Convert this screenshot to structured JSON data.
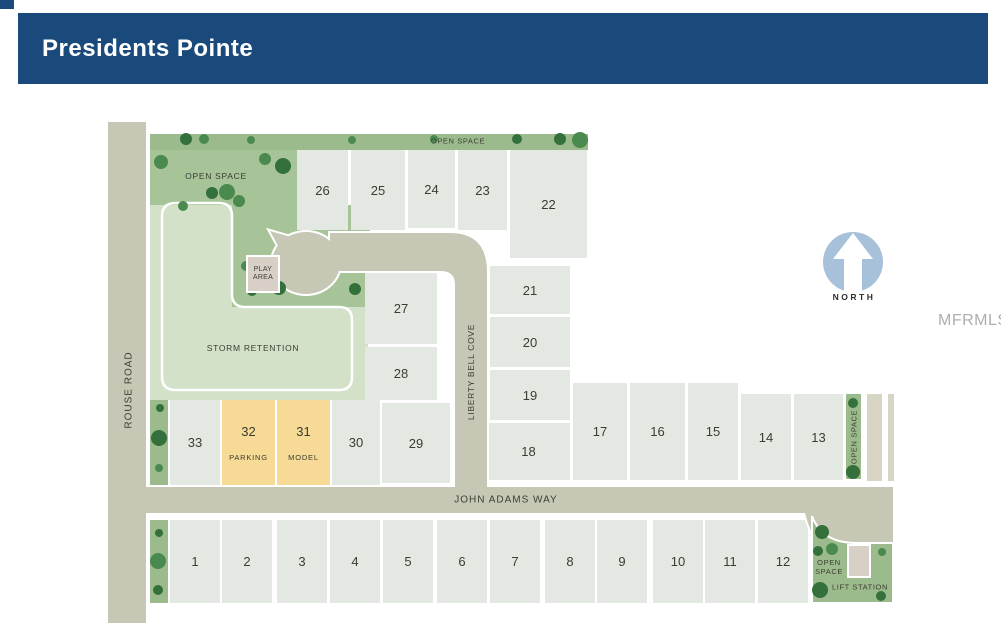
{
  "header": {
    "title": "Presidents Pointe"
  },
  "watermark": "MFRMLS",
  "compass": {
    "label": "NORTH"
  },
  "streets": {
    "rouse_road": "ROUSE ROAD",
    "john_adams_way": "JOHN ADAMS WAY",
    "liberty_bell_cove": "LIBERTY BELL COVE"
  },
  "labels": {
    "open_space_top": "OPEN SPACE",
    "open_space_left": "OPEN SPACE",
    "open_space_right": "OPEN SPACE",
    "open_space_bottom_right": "OPEN SPACE",
    "storm_retention": "STORM RETENTION",
    "play_area": "PLAY AREA",
    "lift_station": "LIFT STATION"
  },
  "colors": {
    "header_blue": "#1a4a7c",
    "road": "#c6c8b5",
    "strip_tan": "#d9d5c5",
    "green_dark": "#9cbb8c",
    "green_open": "#a6c497",
    "green_light": "#d3e1c8",
    "lot_fill": "#e3e9e2",
    "lot_yellow": "#f6da95",
    "pad_tan": "#d8cfc6",
    "compass_blue": "#a7c1da",
    "white": "#ffffff"
  },
  "lots": [
    {
      "n": "1",
      "x": 170,
      "y": 520,
      "w": 50,
      "h": 83,
      "kind": "standard"
    },
    {
      "n": "2",
      "x": 222,
      "y": 520,
      "w": 50,
      "h": 83,
      "kind": "standard"
    },
    {
      "n": "3",
      "x": 277,
      "y": 520,
      "w": 50,
      "h": 83,
      "kind": "standard"
    },
    {
      "n": "4",
      "x": 330,
      "y": 520,
      "w": 50,
      "h": 83,
      "kind": "standard"
    },
    {
      "n": "5",
      "x": 383,
      "y": 520,
      "w": 50,
      "h": 83,
      "kind": "standard"
    },
    {
      "n": "6",
      "x": 437,
      "y": 520,
      "w": 50,
      "h": 83,
      "kind": "standard"
    },
    {
      "n": "7",
      "x": 490,
      "y": 520,
      "w": 50,
      "h": 83,
      "kind": "standard"
    },
    {
      "n": "8",
      "x": 545,
      "y": 520,
      "w": 50,
      "h": 83,
      "kind": "standard"
    },
    {
      "n": "9",
      "x": 597,
      "y": 520,
      "w": 50,
      "h": 83,
      "kind": "standard"
    },
    {
      "n": "10",
      "x": 653,
      "y": 520,
      "w": 50,
      "h": 83,
      "kind": "standard"
    },
    {
      "n": "11",
      "x": 705,
      "y": 520,
      "w": 50,
      "h": 83,
      "kind": "standard"
    },
    {
      "n": "12",
      "x": 758,
      "y": 520,
      "w": 50,
      "h": 83,
      "kind": "standard"
    },
    {
      "n": "13",
      "x": 794,
      "y": 394,
      "w": 49,
      "h": 86,
      "kind": "standard"
    },
    {
      "n": "14",
      "x": 741,
      "y": 394,
      "w": 50,
      "h": 86,
      "kind": "standard"
    },
    {
      "n": "15",
      "x": 688,
      "y": 383,
      "w": 50,
      "h": 97,
      "kind": "standard"
    },
    {
      "n": "16",
      "x": 630,
      "y": 383,
      "w": 55,
      "h": 97,
      "kind": "standard"
    },
    {
      "n": "17",
      "x": 573,
      "y": 383,
      "w": 54,
      "h": 97,
      "kind": "standard"
    },
    {
      "n": "18",
      "x": 487,
      "y": 423,
      "w": 83,
      "h": 57,
      "kind": "standard"
    },
    {
      "n": "19",
      "x": 490,
      "y": 370,
      "w": 80,
      "h": 50,
      "kind": "standard"
    },
    {
      "n": "20",
      "x": 490,
      "y": 317,
      "w": 80,
      "h": 50,
      "kind": "standard"
    },
    {
      "n": "21",
      "x": 490,
      "y": 266,
      "w": 80,
      "h": 48,
      "kind": "standard"
    },
    {
      "n": "22",
      "x": 510,
      "y": 150,
      "w": 77,
      "h": 108,
      "kind": "standard"
    },
    {
      "n": "23",
      "x": 458,
      "y": 150,
      "w": 49,
      "h": 80,
      "kind": "standard"
    },
    {
      "n": "24",
      "x": 408,
      "y": 150,
      "w": 47,
      "h": 78,
      "kind": "standard"
    },
    {
      "n": "25",
      "x": 351,
      "y": 150,
      "w": 54,
      "h": 80,
      "kind": "standard"
    },
    {
      "n": "26",
      "x": 297,
      "y": 150,
      "w": 51,
      "h": 80,
      "kind": "standard"
    },
    {
      "n": "27",
      "x": 365,
      "y": 272,
      "w": 72,
      "h": 72,
      "kind": "standard"
    },
    {
      "n": "28",
      "x": 365,
      "y": 347,
      "w": 72,
      "h": 53,
      "kind": "standard"
    },
    {
      "n": "29",
      "x": 382,
      "y": 403,
      "w": 68,
      "h": 80,
      "kind": "standard"
    },
    {
      "n": "30",
      "x": 332,
      "y": 400,
      "w": 48,
      "h": 85,
      "kind": "standard"
    },
    {
      "n": "31",
      "x": 277,
      "y": 400,
      "w": 53,
      "h": 85,
      "kind": "model",
      "tag": "MODEL"
    },
    {
      "n": "32",
      "x": 222,
      "y": 400,
      "w": 53,
      "h": 85,
      "kind": "parking",
      "tag": "PARKING"
    },
    {
      "n": "33",
      "x": 170,
      "y": 400,
      "w": 50,
      "h": 85,
      "kind": "standard"
    }
  ],
  "trees": [
    [
      186,
      139,
      6,
      "d"
    ],
    [
      204,
      139,
      5,
      "m"
    ],
    [
      251,
      140,
      4,
      "m"
    ],
    [
      352,
      140,
      4,
      "m"
    ],
    [
      434,
      139,
      4,
      "m"
    ],
    [
      517,
      139,
      5,
      "d"
    ],
    [
      560,
      139,
      6,
      "d"
    ],
    [
      580,
      140,
      8,
      "m"
    ],
    [
      161,
      162,
      7,
      "m"
    ],
    [
      183,
      206,
      5,
      "m"
    ],
    [
      265,
      159,
      6,
      "m"
    ],
    [
      283,
      166,
      8,
      "d"
    ],
    [
      212,
      193,
      6,
      "d"
    ],
    [
      227,
      192,
      8,
      "m"
    ],
    [
      239,
      201,
      6,
      "m"
    ],
    [
      246,
      266,
      5,
      "m"
    ],
    [
      279,
      288,
      7,
      "d"
    ],
    [
      252,
      291,
      5,
      "d"
    ],
    [
      355,
      289,
      6,
      "d"
    ],
    [
      160,
      408,
      4,
      "d"
    ],
    [
      159,
      438,
      8,
      "d"
    ],
    [
      159,
      468,
      4,
      "m"
    ],
    [
      159,
      533,
      4,
      "d"
    ],
    [
      158,
      561,
      8,
      "m"
    ],
    [
      158,
      590,
      5,
      "d"
    ],
    [
      853,
      403,
      5,
      "d"
    ],
    [
      853,
      472,
      7,
      "d"
    ],
    [
      822,
      532,
      7,
      "d"
    ],
    [
      832,
      549,
      6,
      "m"
    ],
    [
      818,
      551,
      5,
      "d"
    ],
    [
      820,
      590,
      8,
      "d"
    ],
    [
      882,
      552,
      4,
      "m"
    ],
    [
      881,
      596,
      5,
      "d"
    ]
  ]
}
